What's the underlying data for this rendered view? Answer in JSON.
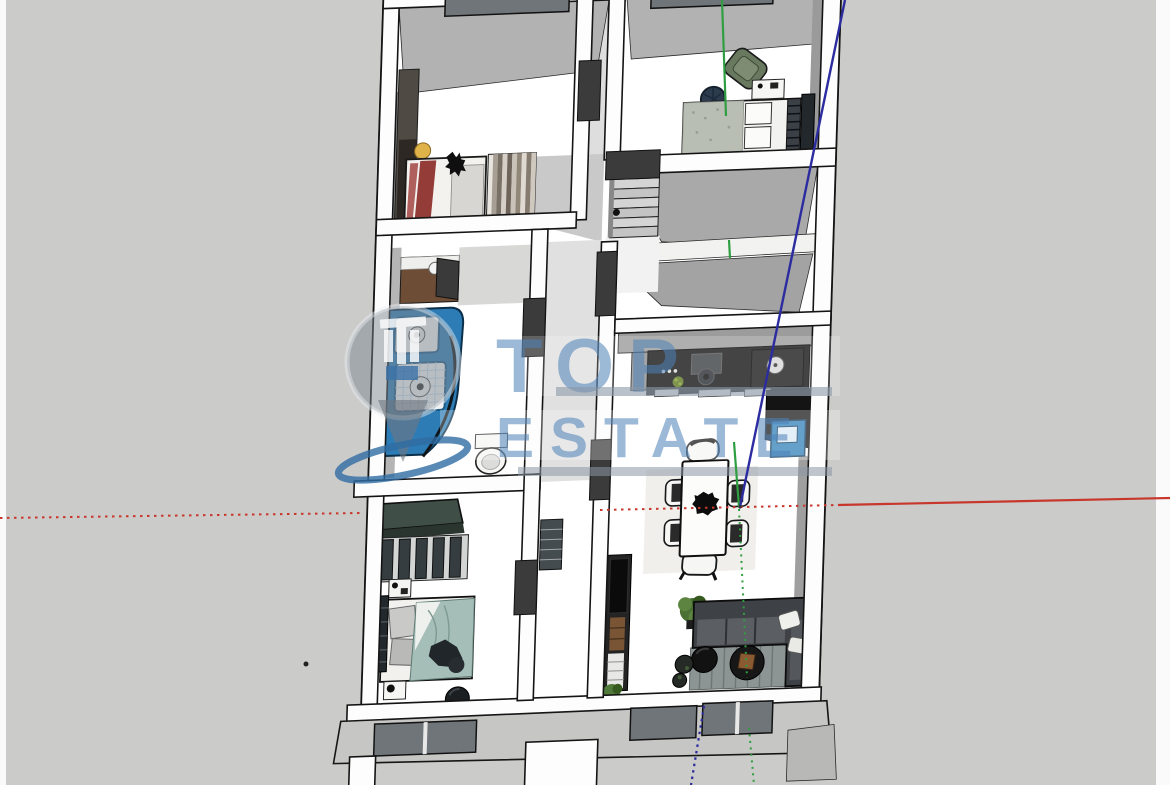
{
  "scene": {
    "description": "3D floor plan model of a single-storey house seen from above, SketchUp-style render with drawing axes",
    "watermark": {
      "line1": "TOP",
      "line2": "ESTATE"
    },
    "colors": {
      "background": "#cbcbc9",
      "edge_strip": "#fafafa",
      "glass": "#70757a",
      "facade": "#c6c6c4",
      "axis_red": "#c8372c",
      "axis_green": "#2f9e41",
      "axis_blue": "#2c2ca0",
      "watermark_blue": "#4d82b8",
      "watermark_gray": "#7e8791",
      "watermark_underline": "#8a98a6",
      "swoosh_blue": "#2f6ba3",
      "shower_blue": "#2d7cb5",
      "cabinet_blue": "#2a7cb8",
      "armchair_green": "#68795f",
      "sofa_dark": "#3e4246",
      "plant_green": "#4b7034",
      "duvet_teal": "#a6beb8",
      "wardrobe_teal": "#3f4f48",
      "bed_red": "#943c38",
      "wood_brown": "#6e4d36",
      "counter_black": "#161616",
      "rug_navy": "#2c3b4e",
      "lamp_yellow": "#e0b24a"
    }
  }
}
